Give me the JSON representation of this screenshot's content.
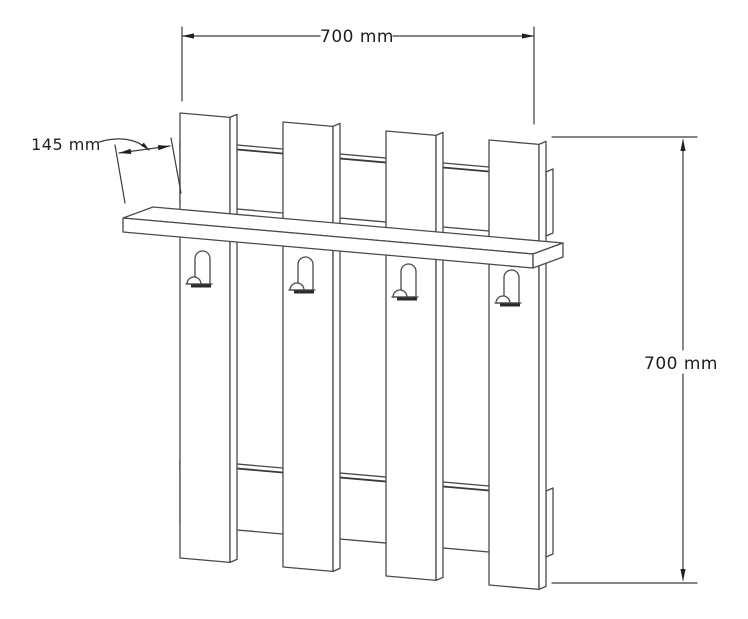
{
  "annotations": {
    "width_dim": "700 mm",
    "depth_dim": "145 mm",
    "height_dim": "700 mm"
  },
  "colors": {
    "background": "#ffffff",
    "line": "#4a4a4a",
    "dimension_line": "#3c3c3c",
    "text": "#1f1f1f"
  }
}
